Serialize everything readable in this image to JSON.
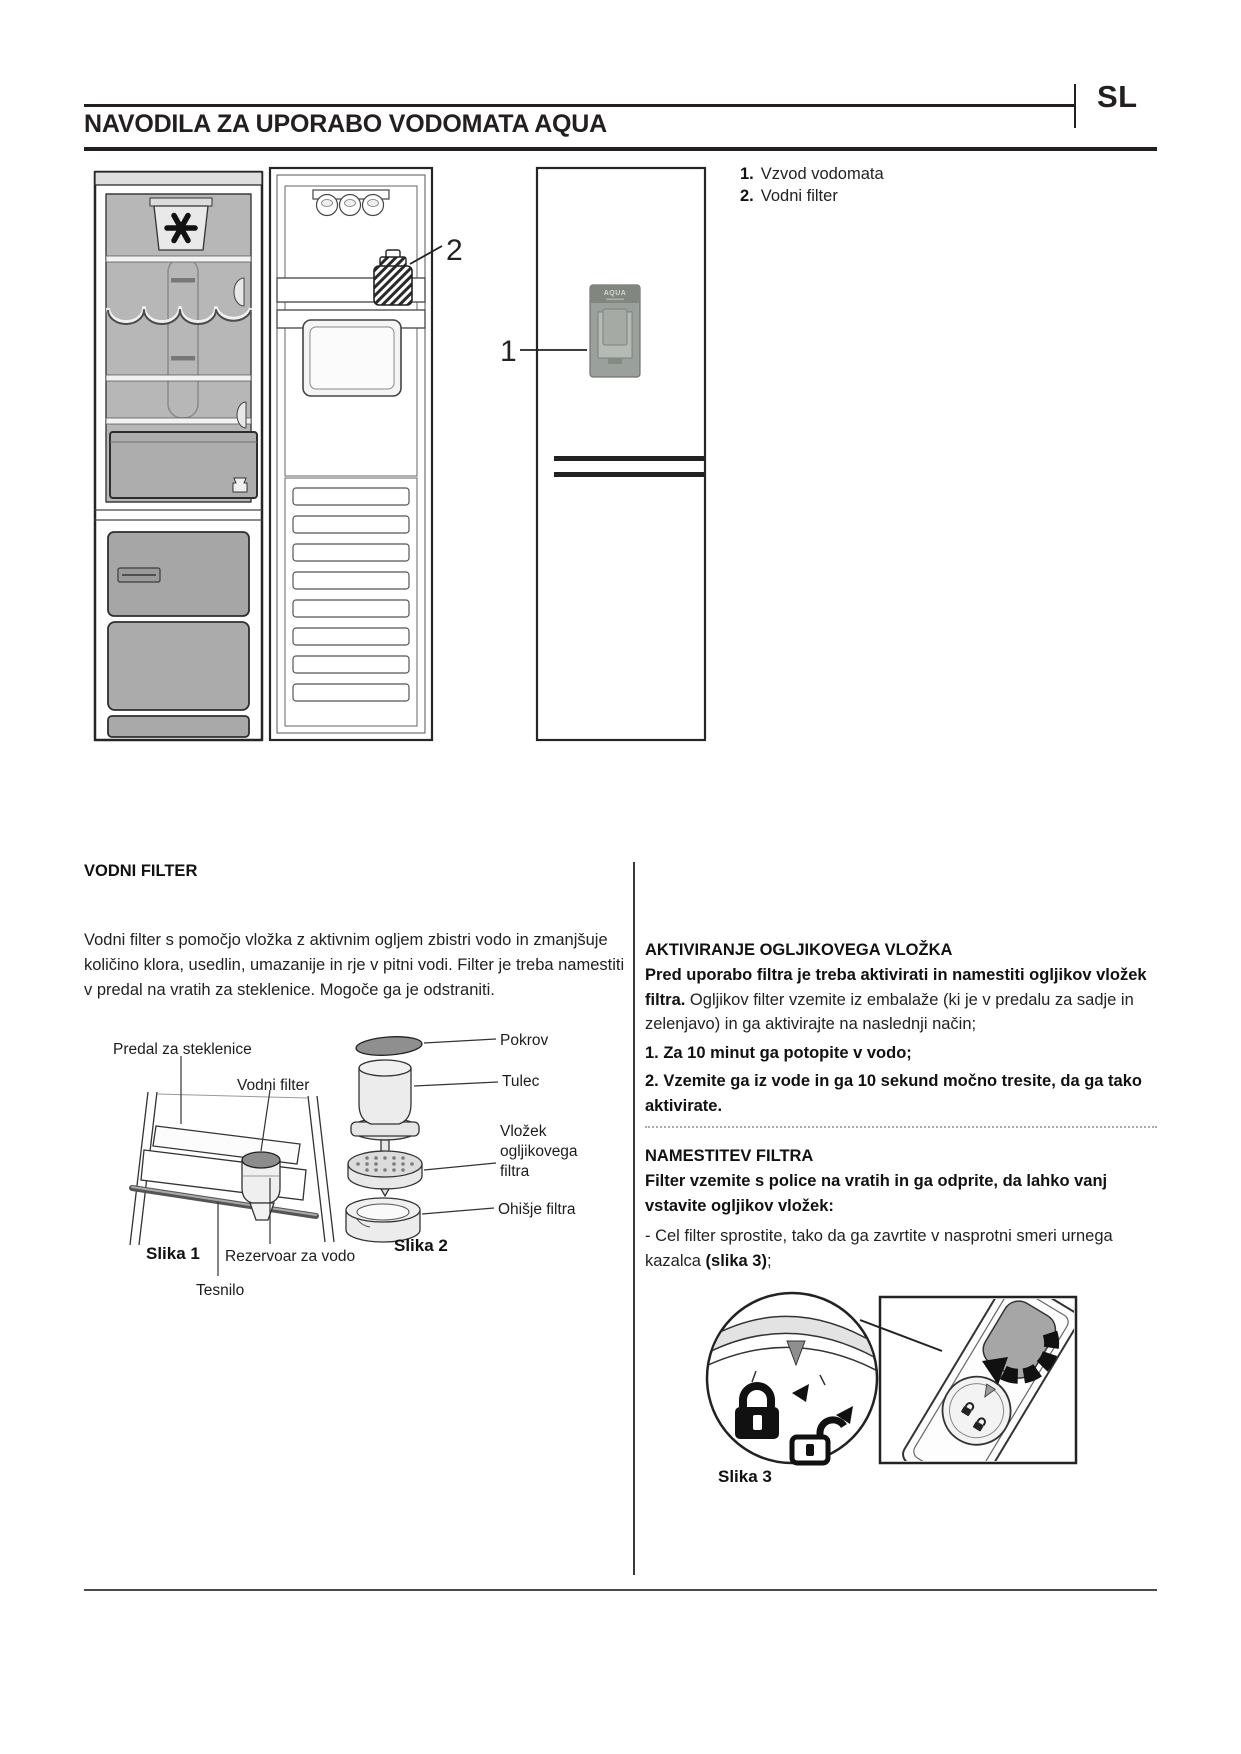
{
  "header": {
    "lang": "SL",
    "title": "NAVODILA ZA UPORABO VODOMATA AQUA"
  },
  "legend": {
    "items": [
      {
        "num": "1.",
        "label": "Vzvod vodomata"
      },
      {
        "num": "2.",
        "label": "Vodni filter"
      }
    ]
  },
  "diagram": {
    "callout_1": "1",
    "callout_2": "2",
    "dispenser_text": "AQUA"
  },
  "left": {
    "heading": "VODNI FILTER",
    "paragraph": "Vodni filter s pomočjo vložka z aktivnim ogljem zbistri vodo in zmanjšuje količino klora, usedlin, umazanije in rje v pitni vodi. Filter je treba namestiti v predal na vratih za steklenice. Mogoče ga je odstraniti.",
    "fig1": {
      "label_shelf": "Predal za steklenice",
      "label_filter": "Vodni filter",
      "label_reservoir": "Rezervoar za vodo",
      "label_seal": "Tesnilo",
      "caption": "Slika 1"
    },
    "fig2": {
      "label_cap": "Pokrov",
      "label_sleeve": "Tulec",
      "label_cartridge": "Vložek ogljikovega filtra",
      "label_housing": "Ohišje filtra",
      "caption": "Slika 2"
    }
  },
  "right": {
    "activation": {
      "heading": "AKTIVIRANJE OGLJIKOVEGA VLOŽKA",
      "lead_bold": "Pred uporabo filtra je treba aktivirati in namestiti ogljikov vložek filtra.",
      "lead_rest": " Ogljikov filter vzemite iz embalaže (ki je v predalu za sadje in zelenjavo) in ga aktivirajte na naslednji način;",
      "step_1": "1. Za 10 minut ga potopite v vodo;",
      "step_2": "2. Vzemite ga iz vode in ga 10 sekund močno tresite, da ga tako aktivirate."
    },
    "installation": {
      "heading": "NAMESTITEV FILTRA",
      "lead_bold": "Filter vzemite s police na vratih in ga odprite, da lahko vanj vstavite ogljikov vložek:",
      "bullet_pre": "- Cel filter sprostite, tako da ga zavrtite v nasprotni smeri urnega kazalca ",
      "bullet_bold": "(slika 3)",
      "bullet_post": ";",
      "caption": "Slika 3"
    }
  }
}
